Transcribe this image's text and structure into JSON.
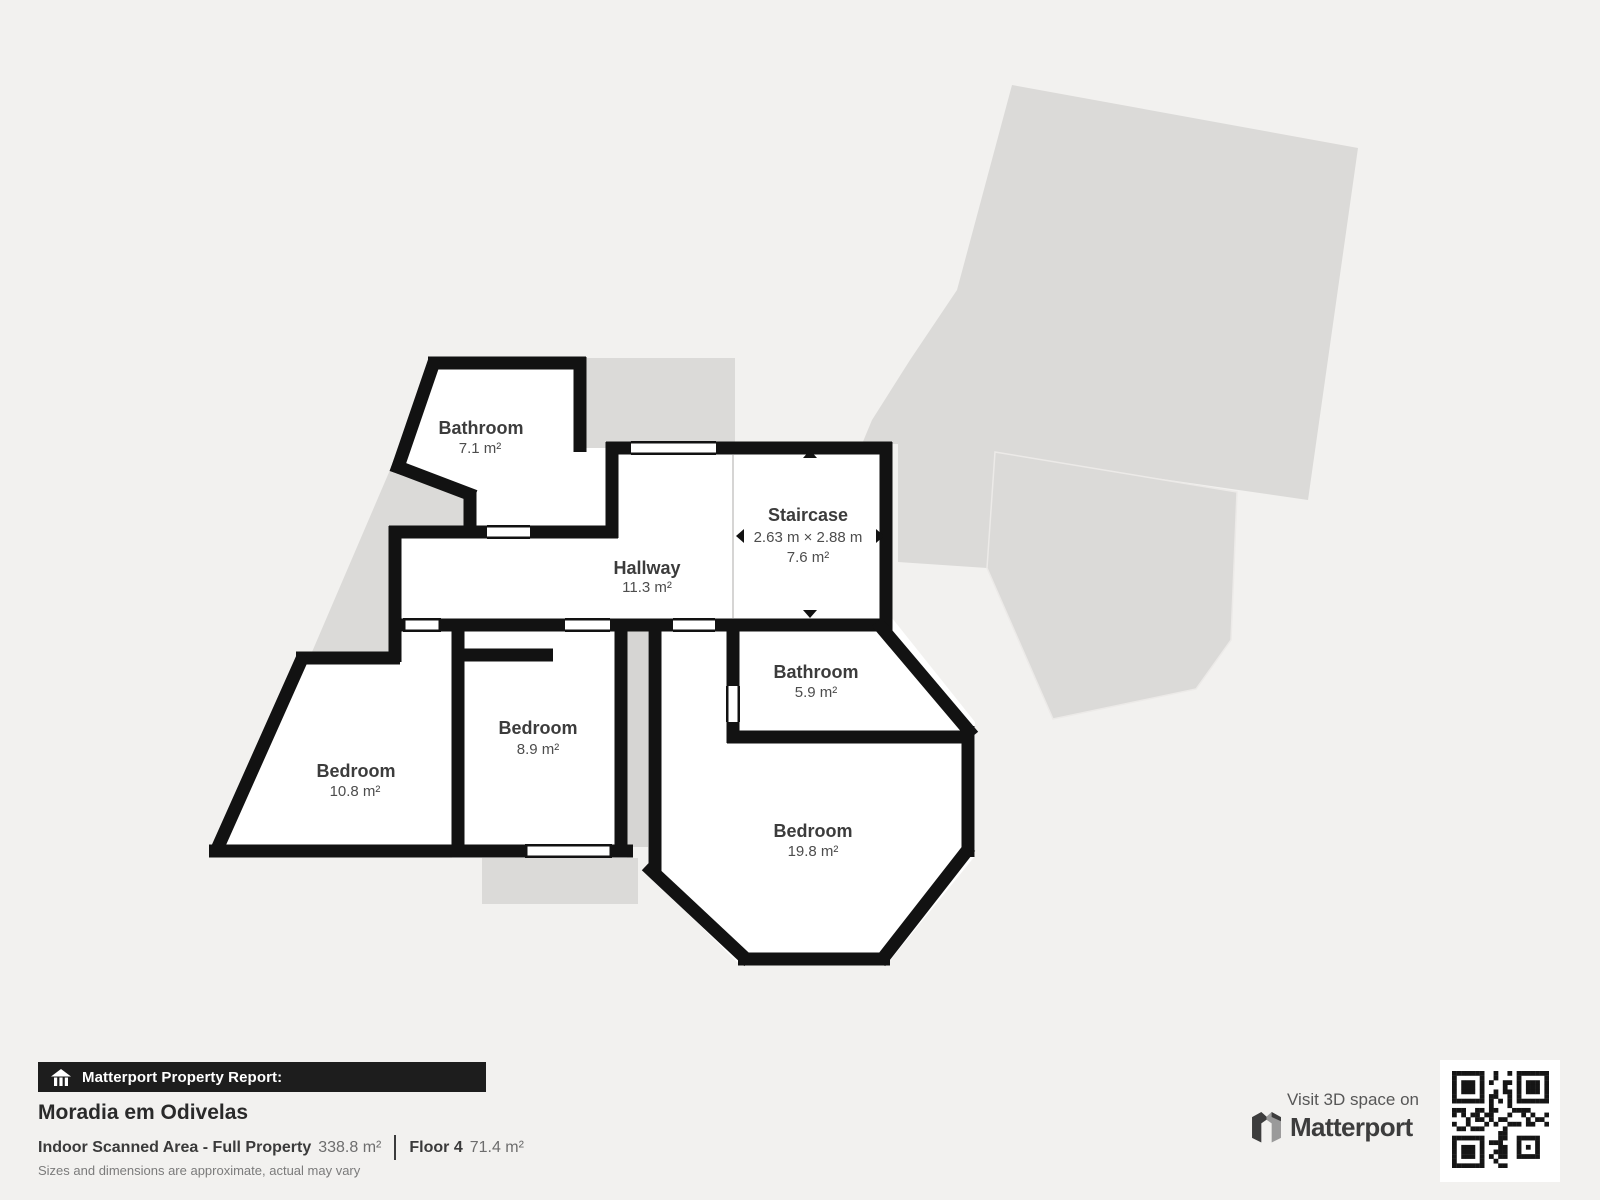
{
  "plan": {
    "rooms": {
      "bathroom_top": {
        "name": "Bathroom",
        "area": "7.1 m²"
      },
      "staircase": {
        "name": "Staircase",
        "dims": "2.63 m × 2.88 m",
        "area": "7.6 m²"
      },
      "hallway": {
        "name": "Hallway",
        "area": "11.3 m²"
      },
      "bathroom_right": {
        "name": "Bathroom",
        "area": "5.9 m²"
      },
      "bedroom_left": {
        "name": "Bedroom",
        "area": "10.8 m²"
      },
      "bedroom_mid": {
        "name": "Bedroom",
        "area": "8.9 m²"
      },
      "bedroom_big": {
        "name": "Bedroom",
        "area": "19.8 m²"
      }
    },
    "icons": {
      "dimension_arrows": "triangle-arrows marking measured extent"
    }
  },
  "footer": {
    "report_label": "Matterport Property Report:",
    "property_name": "Moradia em Odivelas",
    "scanned_area_label": "Indoor Scanned Area - Full Property",
    "scanned_area_value": "338.8 m²",
    "floor_label": "Floor 4",
    "floor_value": "71.4 m²",
    "disclaimer": "Sizes and dimensions are approximate, actual may vary"
  },
  "cta": {
    "visit_text": "Visit 3D space on",
    "brand": "Matterport"
  },
  "colors": {
    "background": "#f2f1ef",
    "wall": "#121212",
    "room_fill": "#ffffff",
    "unscanned_gray": "#dbdad8",
    "bar_black": "#1d1d1d",
    "label_text": "#3c3c3c"
  }
}
